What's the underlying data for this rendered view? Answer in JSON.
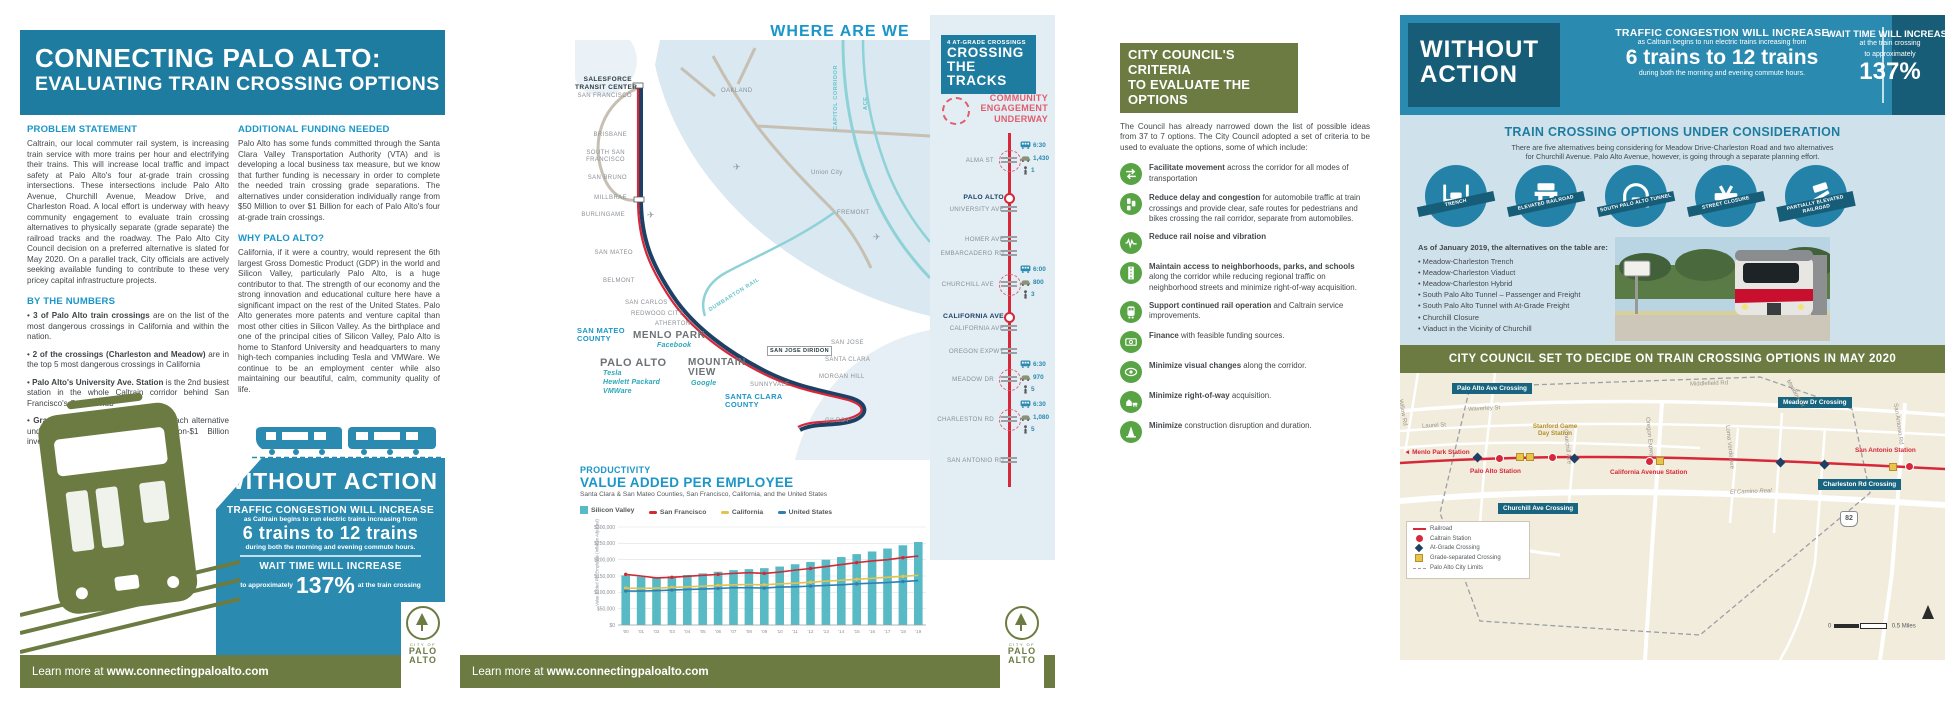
{
  "page1": {
    "banner": {
      "line1": "CONNECTING PALO ALTO:",
      "line2": "EVALUATING TRAIN CROSSING OPTIONS"
    },
    "problem": {
      "heading": "PROBLEM STATEMENT",
      "body": "Caltrain, our local commuter rail system, is increasing train service with more trains per hour and electrifying their trains. This will increase local traffic and impact safety at Palo Alto's four at-grade train crossing intersections. These intersections include Palo Alto Avenue, Churchill Avenue, Meadow Drive, and Charleston Road. A local effort is underway with heavy community engagement to evaluate train crossing alternatives to physically separate (grade separate) the railroad tracks and the roadway. The Palo Alto City Council decision on a preferred alternative is slated for May 2020. On a parallel track, City officials are actively seeking available funding to contribute to these very pricey capital infrastructure projects."
    },
    "numbers": {
      "heading": "BY THE NUMBERS",
      "bullets": [
        {
          "bold": "3 of Palo Alto train crossings",
          "text": " are on the list of the most dangerous crossings in California and within the nation."
        },
        {
          "bold": "2 of the crossings (Charleston and Meadow)",
          "text": " are in the top 5 most dangerous crossings in California"
        },
        {
          "bold": "Palo Alto's University Ave. Station",
          "text": " is the 2nd busiest station in the whole Caltrain corridor behind San Francisco's Caltrain hub"
        },
        {
          "bold": "Grade Separations are expensive:",
          "text": " each alternative under consideration is a $50 Million-$1 Billion investment"
        }
      ]
    },
    "funding": {
      "heading": "ADDITIONAL FUNDING NEEDED",
      "body": "Palo Alto has some funds committed through the Santa Clara Valley Transportation Authority (VTA) and is developing a local business tax measure, but we know that further funding is necessary in order to complete the needed train crossing grade separations. The alternatives under consideration individually range from $50 Million to over $1 Billion for each of Palo Alto's four at-grade train crossings."
    },
    "why": {
      "heading": "WHY PALO ALTO?",
      "body": "California, if it were a country, would represent the 6th largest Gross Domestic Product (GDP) in the world and Silicon Valley, particularly Palo Alto, is a huge contributor to that. The strength of our economy and the strong innovation and educational culture here have a significant impact on the rest of the United States. Palo Alto generates more patents and venture capital than most other cities in Silicon Valley. As the birthplace and one of the principal cities of Silicon Valley, Palo Alto is home to Stanford University and headquarters to many high-tech companies including Tesla and VMWare. We continue to be an employment center while also maintaining our beautiful, calm, community quality of life."
    },
    "without_action": {
      "title": "WITHOUT ACTION",
      "congestion_heading": "TRAFFIC CONGESTION WILL INCREASE",
      "congestion_sub": "as Caltrain begins to run electric trains increasing from",
      "trains": "6 trains to 12 trains",
      "commute": "during both the morning and evening commute hours.",
      "wait_heading": "WAIT TIME WILL INCREASE",
      "wait_pre": "to approximately",
      "wait_value": "137%",
      "wait_post": "at the train crossing"
    },
    "footer": {
      "pre": "Learn more at ",
      "url": "www.connectingpaloalto.com"
    }
  },
  "logo": {
    "city_of": "CITY OF",
    "palo": "PALO",
    "alto": "ALTO"
  },
  "page2": {
    "map": {
      "title": "WHERE ARE WE",
      "legend": [
        {
          "label": "Caltrain",
          "color": "#d62839"
        },
        {
          "label": "BART",
          "color": "#c7bfb2"
        },
        {
          "label": "High Speed Rail",
          "color": "#1d4064"
        },
        {
          "label": "Other Rail",
          "color": "#8ed2d7"
        }
      ],
      "labels": {
        "salesforce1": "SALESFORCE",
        "salesforce2": "TRANSIT CENTER",
        "sf": "SAN FRANCISCO",
        "oakland": "OAKLAND",
        "brisbane": "BRISBANE",
        "ssf1": "SOUTH SAN",
        "ssf2": "FRANCISCO",
        "sanbruno": "SAN BRUNO",
        "millbrae": "MILLBRAE",
        "burlingame": "BURLINGAME",
        "sanmateo": "SAN MATEO",
        "belmont": "BELMONT",
        "sancarlos": "SAN CARLOS",
        "redwood": "REDWOOD CITY",
        "atherton": "ATHERTON",
        "menlopark": "MENLO PARK",
        "facebook": "Facebook",
        "smcounty1": "SAN MATEO",
        "smcounty2": "COUNTY",
        "paloalto": "PALO ALTO",
        "tesla": "Tesla",
        "hp": "Hewlett Packard",
        "vmware": "VMWare",
        "mtview1": "MOUNTAIN",
        "mtview2": "VIEW",
        "google": "Google",
        "sunnyvale": "SUNNYVALE",
        "sjdiridon": "SAN JOSE DIRIDON",
        "sanjose": "SAN JOSE",
        "santaclara": "SANTA CLARA",
        "morganhill": "MORGAN HILL",
        "sccounty1": "SANTA CLARA",
        "sccounty2": "COUNTY",
        "gilroy": "GILROY",
        "unioncity": "Union City",
        "fremont": "FREMONT",
        "dumbarton": "DUMBARTON RAIL",
        "capitol": "CAPITOL CORRIDOR",
        "ace": "ACE"
      }
    },
    "chart": {
      "kicker": "PRODUCTIVITY",
      "title": "VALUE ADDED PER EMPLOYEE",
      "subtitle": "Santa Clara & San Mateo Counties, San Francisco, California, and the United States",
      "ylabel": "Value Added Per Employee (Inflation Adjusted)"
    },
    "crossings": {
      "header_kicker": "4 AT-GRADE CROSSINGS",
      "header1": "CROSSING",
      "header2": "THE TRACKS",
      "engagement1": "COMMUNITY",
      "engagement2": "ENGAGEMENT",
      "engagement3": "UNDERWAY",
      "stops": [
        {
          "label": "ALMA ST",
          "time": "6:30",
          "cars": "1,430",
          "peds": "1"
        },
        {
          "station": "PALO ALTO",
          "street": "UNIVERSITY AVE"
        },
        {
          "label": "HOMER AVE"
        },
        {
          "label": "EMBARCADERO RD"
        },
        {
          "label": "CHURCHILL AVE",
          "time": "6:00",
          "cars": "800",
          "peds": "3"
        },
        {
          "station": "CALIFORNIA AVE",
          "street": "CALIFORNIA AVE"
        },
        {
          "label": "OREGON EXPWY"
        },
        {
          "label": "MEADOW DR",
          "time": "6:30",
          "cars": "970",
          "peds": "5"
        },
        {
          "label": "CHARLESTON RD",
          "time": "6:30",
          "cars": "1,080",
          "peds": "5"
        },
        {
          "label": "SAN ANTONIO RD"
        }
      ]
    },
    "footer": {
      "pre": "Learn more at ",
      "url": "www.connectingpaloalto.com"
    }
  },
  "page3": {
    "criteria": {
      "header1": "CITY COUNCIL'S CRITERIA",
      "header2": "TO EVALUATE THE OPTIONS",
      "intro": "The Council has already narrowed down the list of possible ideas from 37 to 7 options. The City Council adopted a set of criteria to be used to evaluate the options, some of which include:",
      "items": [
        {
          "bold": "Facilitate movement",
          "text": " across the corridor for all modes of transportation"
        },
        {
          "bold": "Reduce delay and congestion",
          "text": " for automobile traffic at train crossings and provide clear, safe routes for pedestrians and bikes crossing the rail corridor, separate from automobiles."
        },
        {
          "bold": "Reduce rail noise and vibration",
          "text": ""
        },
        {
          "bold": "Maintain access to neighborhoods, parks, and schools",
          "text": " along the corridor while reducing regional traffic on neighborhood streets and minimize right-of-way acquisition."
        },
        {
          "bold": "Support continued rail operation",
          "text": " and Caltrain service improvements."
        },
        {
          "bold": "Finance",
          "text": " with feasible funding sources."
        },
        {
          "bold": "Minimize visual changes",
          "text": " along the corridor."
        },
        {
          "bold": "Minimize right-of-way",
          "text": " acquisition."
        },
        {
          "bold": "Minimize",
          "text": " construction disruption and duration."
        }
      ]
    },
    "without_action": {
      "title1": "WITHOUT",
      "title2": "ACTION",
      "congestion_heading": "TRAFFIC CONGESTION WILL INCREASE",
      "congestion_sub": "as Caltrain begins to run electric trains increasing from",
      "trains": "6 trains to 12 trains",
      "commute": "during both the morning and evening commute hours.",
      "wait_heading": "WAIT TIME WILL INCREASE",
      "wait_sub": "at the train crossing",
      "wait_pre": "to approximately",
      "wait_value": "137%"
    },
    "options": {
      "heading": "TRAIN CROSSING OPTIONS UNDER CONSIDERATION",
      "body1": "There are five alternatives being considering for Meadow Drive-Charleston Road and two alternatives",
      "body2": "for Churchill Avenue. Palo Alto Avenue, however, is going through a separate planning effort.",
      "circles": [
        "TRENCH",
        "ELEVATED RAILROAD",
        "SOUTH PALO ALTO TUNNEL",
        "STREET CLOSURE",
        "PARTIALLY ELEVATED RAILROAD"
      ],
      "list_intro": "As of January 2019, the alternatives on the table are:",
      "alternatives": [
        "Meadow-Charleston Trench",
        "Meadow-Charleston Viaduct",
        "Meadow-Charleston Hybrid",
        "South Palo Alto Tunnel – Passenger and Freight",
        "South Palo Alto Tunnel with At-Grade Freight",
        "Churchill Closure",
        "Viaduct in the Vicinity of Churchill"
      ]
    },
    "decision_banner": "CITY COUNCIL SET TO DECIDE ON TRAIN CROSSING OPTIONS IN MAY 2020",
    "map": {
      "crossing_labels": [
        "Palo Alto Ave Crossing",
        "Churchill Ave Crossing",
        "Meadow Dr Crossing",
        "Charleston Rd Crossing"
      ],
      "station_labels": [
        "Menlo Park Station",
        "Palo Alto Station",
        "Stanford Game",
        "Day Station",
        "California Avenue Station",
        "San Antonio Station"
      ],
      "streets": [
        "Middlefield Rd",
        "Waverley St",
        "Laurel St",
        "Willow Rd",
        "Churchill Ave",
        "Oregon Expwy",
        "Loma Verde Ave",
        "Meadow Dr",
        "San Antonio Rd",
        "El Camino Real",
        "Campus Dr"
      ],
      "hwy": "82",
      "legend": [
        "Railroad",
        "Caltrain Station",
        "At-Grade Crossing",
        "Grade-separated Crossing",
        "Palo Alto City Limits"
      ],
      "scale0": "0",
      "scale1": "0.5",
      "scale_unit": "Miles"
    }
  },
  "chart_data": {
    "type": "bar+line",
    "kicker": "PRODUCTIVITY",
    "title": "VALUE ADDED PER EMPLOYEE",
    "subtitle": "Santa Clara & San Mateo Counties, San Francisco, California, and the United States",
    "ylabel": "Value Added Per Employee (Inflation Adjusted)",
    "x": [
      "'00",
      "'01",
      "'02",
      "'03",
      "'04",
      "'05",
      "'06",
      "'07",
      "'08",
      "'09",
      "'10",
      "'11",
      "'12",
      "'13",
      "'14",
      "'15",
      "'16",
      "'17",
      "'18",
      "'19"
    ],
    "ylim": [
      0,
      300000
    ],
    "ytick_step": 50000,
    "grid": true,
    "legend_position": "top",
    "bar_series": {
      "name": "Silicon Valley",
      "color": "#57bac5",
      "values": [
        152000,
        148000,
        146000,
        149000,
        153000,
        158000,
        163000,
        168000,
        171000,
        174000,
        179000,
        186000,
        193000,
        200000,
        208000,
        217000,
        225000,
        234000,
        244000,
        254000
      ]
    },
    "line_series": [
      {
        "name": "San Francisco",
        "color": "#cf2a36",
        "values": [
          155000,
          150000,
          144000,
          146000,
          149000,
          152000,
          155000,
          158000,
          160000,
          158000,
          162000,
          168000,
          173000,
          179000,
          185000,
          191000,
          196000,
          200000,
          206000,
          211000
        ]
      },
      {
        "name": "California",
        "color": "#e3c24e",
        "values": [
          113000,
          112000,
          113000,
          115000,
          117000,
          119000,
          121000,
          123000,
          124000,
          123000,
          126000,
          128000,
          131000,
          134000,
          137000,
          140000,
          143000,
          146000,
          149000,
          152000
        ]
      },
      {
        "name": "United States",
        "color": "#2f7fb5",
        "values": [
          104000,
          104000,
          105000,
          107000,
          109000,
          110000,
          112000,
          114000,
          114000,
          113000,
          116000,
          117000,
          119000,
          121000,
          123000,
          126000,
          128000,
          130000,
          133000,
          136000
        ]
      }
    ]
  }
}
